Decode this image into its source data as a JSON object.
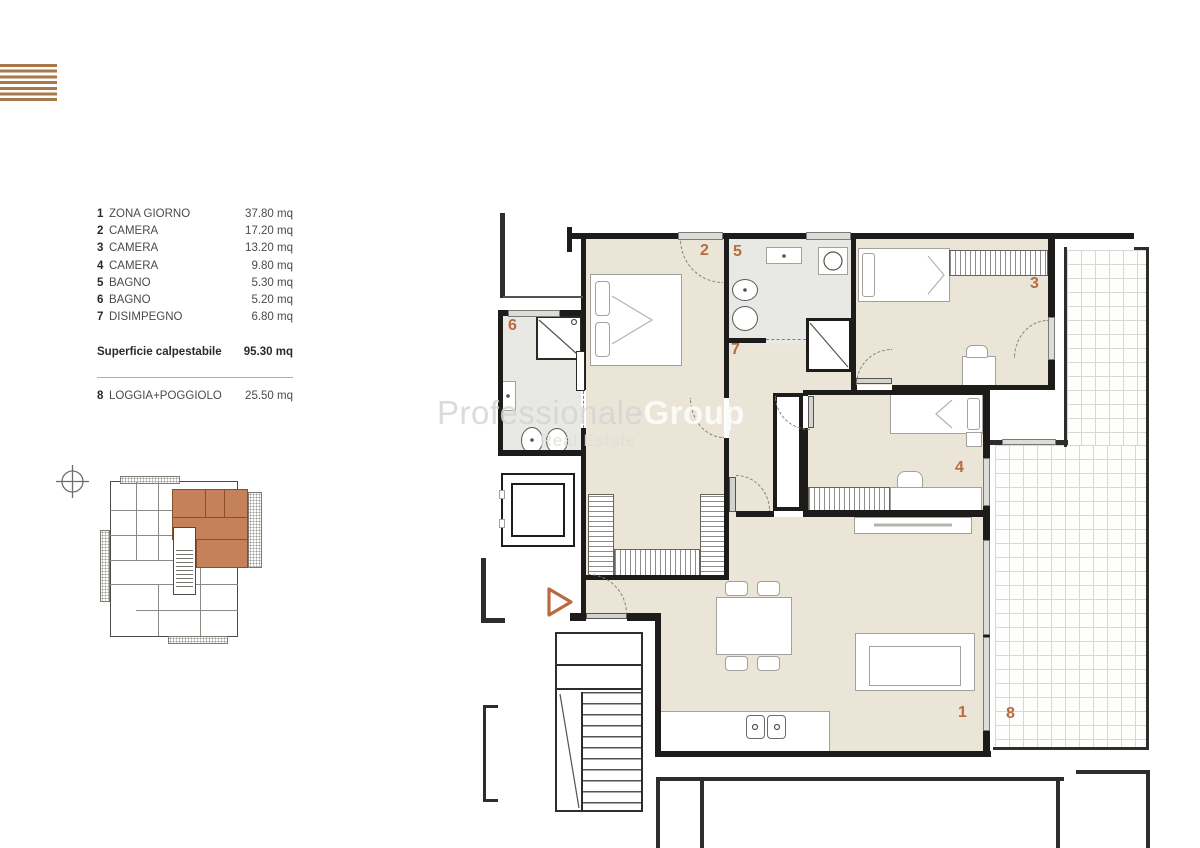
{
  "brand": {
    "logo_stripes": 7,
    "logo_color": "#a87848",
    "accent_color": "#b96a3f",
    "keyplan_highlight": "#c5825a"
  },
  "legend": {
    "rows": [
      {
        "num": "1",
        "label": "ZONA GIORNO",
        "value": "37.80 mq"
      },
      {
        "num": "2",
        "label": "CAMERA",
        "value": "17.20 mq"
      },
      {
        "num": "3",
        "label": "CAMERA",
        "value": "13.20 mq"
      },
      {
        "num": "4",
        "label": "CAMERA",
        "value": "9.80 mq"
      },
      {
        "num": "5",
        "label": "BAGNO",
        "value": "5.30 mq"
      },
      {
        "num": "6",
        "label": "BAGNO",
        "value": "5.20 mq"
      },
      {
        "num": "7",
        "label": "DISIMPEGNO",
        "value": "6.80 mq"
      }
    ],
    "total": {
      "label": "Superficie calpestabile",
      "value": "95.30 mq"
    },
    "extra": {
      "num": "8",
      "label": "LOGGIA+POGGIOLO",
      "value": "25.50 mq"
    }
  },
  "watermark": {
    "light": "Professionale",
    "bold": "Group",
    "sub": "Real Estate"
  },
  "plan": {
    "room_numbers": [
      {
        "n": "1"
      },
      {
        "n": "2"
      },
      {
        "n": "3"
      },
      {
        "n": "4"
      },
      {
        "n": "5"
      },
      {
        "n": "6"
      },
      {
        "n": "7"
      },
      {
        "n": "8"
      }
    ],
    "icons": {
      "entrance": "triangle-right-icon",
      "north": "compass-icon"
    }
  }
}
